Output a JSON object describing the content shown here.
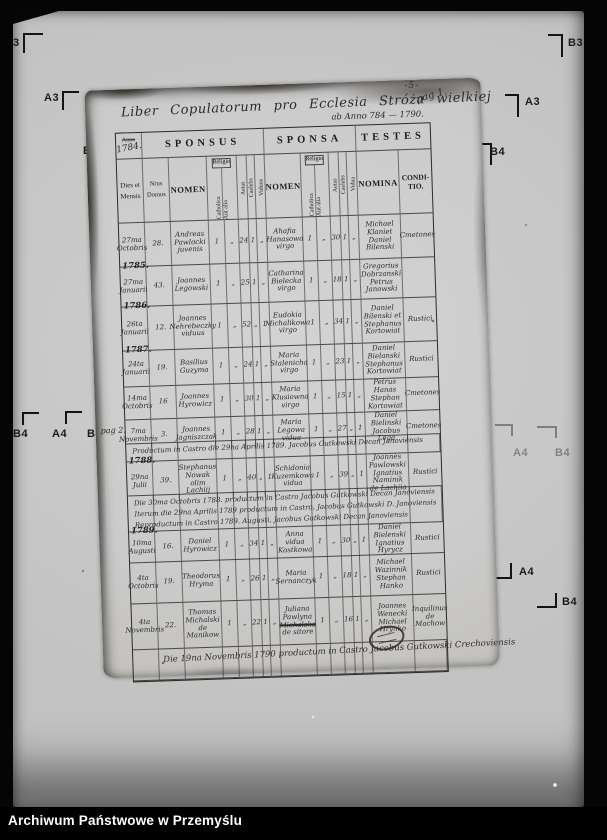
{
  "caption": "Archiwum Państwowe w Przemyślu",
  "fiducials": {
    "left_top": "3",
    "left_a3": "A3",
    "left_b4": "B4",
    "bottom_left_b4": "B4",
    "bottom_left_a4": "A4",
    "bottom_left_b4b": "B4",
    "right_b3": "B3",
    "right_a3": "A3",
    "right_b4": "B4",
    "right_faint_b4": "B4",
    "right_faint_a4": "A4",
    "right_faint_b4b": "B4",
    "right_bold_a4": "A4",
    "right_bold_b4": "B4"
  },
  "document": {
    "page_number_top": "-5-",
    "title": "Liber Copulatorum pro Ecclesia Stróża wielkiej",
    "title_pag": "pag 1.",
    "subtitle": "ab Anno 784 — 1790.",
    "margin_note": "pag 2.",
    "header": {
      "anno_printed": "Anno",
      "anno_written": "1784.",
      "sponsus": "SPONSUS",
      "sponsa": "SPONSA",
      "testes": "TESTES",
      "dies": "Dies et Mensis",
      "nrus": "Nrus Domus",
      "nomen_sponsus": "NOMEN",
      "nomen_sponsa": "NOMEN",
      "religio": "Religio",
      "catholica": "Catholica",
      "aut_alia": "Aut alia",
      "aetas": "Aetas",
      "caelebs": "Caelebs",
      "viduus": "Viduus",
      "vidua": "Vidua",
      "nomina": "NOMINA",
      "conditio": "CONDI-TIO."
    },
    "rows": [
      {
        "kind": "entry",
        "year": "",
        "cells": [
          "27ma Octobris",
          "28.",
          "Andreas Pawlocki juvenis",
          "1",
          "„",
          "24",
          "1",
          "„",
          "Ahafia Hanasowa virgo",
          "1",
          "„",
          "30",
          "1",
          "„",
          "Michael Klaniet Daniel Bilenski",
          "Cmetones"
        ]
      },
      {
        "kind": "entry",
        "year": "1785.",
        "cells": [
          "27ma Januarii",
          "43.",
          "Joannes Legowski",
          "1",
          "„",
          "25",
          "1",
          "„",
          "Catharina Bielecka virgo",
          "1",
          "„",
          "18",
          "1",
          "„",
          "Gregorius Dobrzanski Petrus Janowski",
          ""
        ]
      },
      {
        "kind": "entry",
        "year": "1786.",
        "cells": [
          "26ta Januarii",
          "12.",
          "Joannes Nehrebeczky viduus",
          "1",
          "„",
          "52",
          "„",
          "1",
          "Eudokia Michalikowa virgo",
          "1",
          "„",
          "34",
          "1",
          "„",
          "Daniel Bilenski et Stephanus Kortowiat",
          "Rustici"
        ]
      },
      {
        "kind": "entry",
        "year": "1787.",
        "cells": [
          "24ta Januarii",
          "19.",
          "Basilius Guzyma",
          "1",
          "„",
          "24",
          "1",
          "„",
          "Maria Stalenicha virgo",
          "1",
          "„",
          "23",
          "1",
          "„",
          "Daniel Bielanski Stephanus Kortowiat",
          "Rustici"
        ]
      },
      {
        "kind": "entry",
        "year": "",
        "cells": [
          "14ma Octobris",
          "16",
          "Joannes Hyrowicz",
          "1",
          "„",
          "30",
          "1",
          "„",
          "Maria Klusiowna virgo",
          "1",
          "„",
          "15",
          "1",
          "„",
          "Petrus Hanas Stephan Kortowiat",
          "Cmetones"
        ]
      },
      {
        "kind": "entry",
        "year": "",
        "cells": [
          "7ma Novembris",
          "3.",
          "Joannes Jagniszczak",
          "1",
          "„",
          "28",
          "1",
          "„",
          "Maria Legowa vidua",
          "1",
          "„",
          "27",
          "„",
          "1",
          "Daniel Bielinski Jacobus Lega",
          "Cmetones"
        ]
      },
      {
        "kind": "note",
        "lines": [
          "Productum in Castro die 29na Aprilis 1789. Jacobus Gutkowski Decan Janoviensis"
        ]
      },
      {
        "kind": "entry",
        "year": "1788.",
        "cells": [
          "29na Julii",
          "39.",
          "Stephanus Nowak olim Lachiij",
          "1",
          "„",
          "40",
          "„",
          "1",
          "Schidonia Kuzemkowa vidua",
          "1",
          "„",
          "39",
          "„",
          "1",
          "Joannes Pawlowski Ignatius Naminik de Lachiia",
          "Rustici"
        ]
      },
      {
        "kind": "note",
        "lines": [
          "Die 30ma Octobris 1788. productum in Castro Jacobus Gutkowski Decan Janoviensis",
          "Iterum die 29na Aprilis 1789 productum in Castro, Jacobus Gutkowski D. Janoviensis",
          "Reproductum in Castro 1789. Augusti, Jacobus Gutkowski Decan Janoviensis"
        ]
      },
      {
        "kind": "entry",
        "year": "1789.",
        "cells": [
          "10ma Augusti",
          "16.",
          "Daniel Hyrowicz",
          "1",
          "„",
          "34",
          "1",
          "„",
          "Anna vidua Kostkowa",
          "1",
          "„",
          "30",
          "„",
          "1",
          "Daniel Bielenski Ignatius Hyrycz",
          "Rustici"
        ]
      },
      {
        "kind": "entry",
        "year": "",
        "cells": [
          "4ta Octobris",
          "19.",
          "Theodorus Hryma",
          "1",
          "„",
          "26",
          "1",
          "„",
          "Maria Sernanczyk",
          "1",
          "„",
          "18",
          "1",
          "„",
          "Michael Wazinnik Stephan Hanko",
          "Rustici"
        ]
      },
      {
        "kind": "entry",
        "year": "",
        "cells": [
          "4ta Novembris",
          "22.",
          "Thomas Michalski de Manikow",
          "1",
          "„",
          "22",
          "1",
          "„",
          [
            {
              "t": "Juliana Pawlyna"
            },
            {
              "t": "Michalska",
              "s": true
            },
            {
              "t": "de sitore"
            }
          ],
          "1",
          "„",
          "16",
          "1",
          "„",
          "Joannes Wenecki Michael Hrynko",
          "Inquilinus de Machow"
        ]
      },
      {
        "kind": "note",
        "big": true,
        "lines": [
          "Die 19na Novembris 1790 productum in Castro Jacobus Gutkowski Crechoviensis"
        ]
      }
    ]
  }
}
